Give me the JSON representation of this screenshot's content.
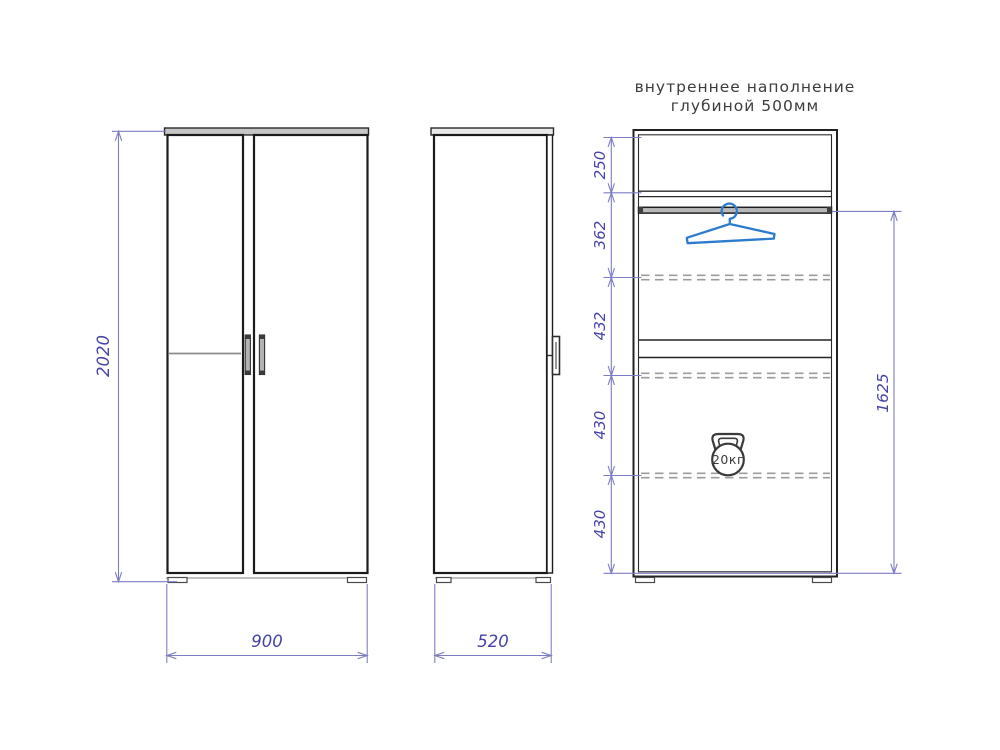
{
  "annotation": {
    "line1": "внутреннее наполнение",
    "line2": "глубиной 500мм"
  },
  "dimensions": {
    "front_height": "2020",
    "front_width": "900",
    "side_depth": "520",
    "internal_sections": [
      "250",
      "362",
      "432",
      "430",
      "430"
    ],
    "hanging_zone_height": "1625"
  },
  "icons": {
    "hanger": "clothes-hanger-icon",
    "weight": "kettlebell-weight-icon",
    "weight_label": "20кг"
  },
  "colors": {
    "outline": "#1b1b1b",
    "secondary_line": "#9a9a9a",
    "dimension_line": "#7d7dc2",
    "dimension_text": "#4343a8",
    "hanger_blue": "#2b7ccd",
    "background": "#ffffff"
  }
}
